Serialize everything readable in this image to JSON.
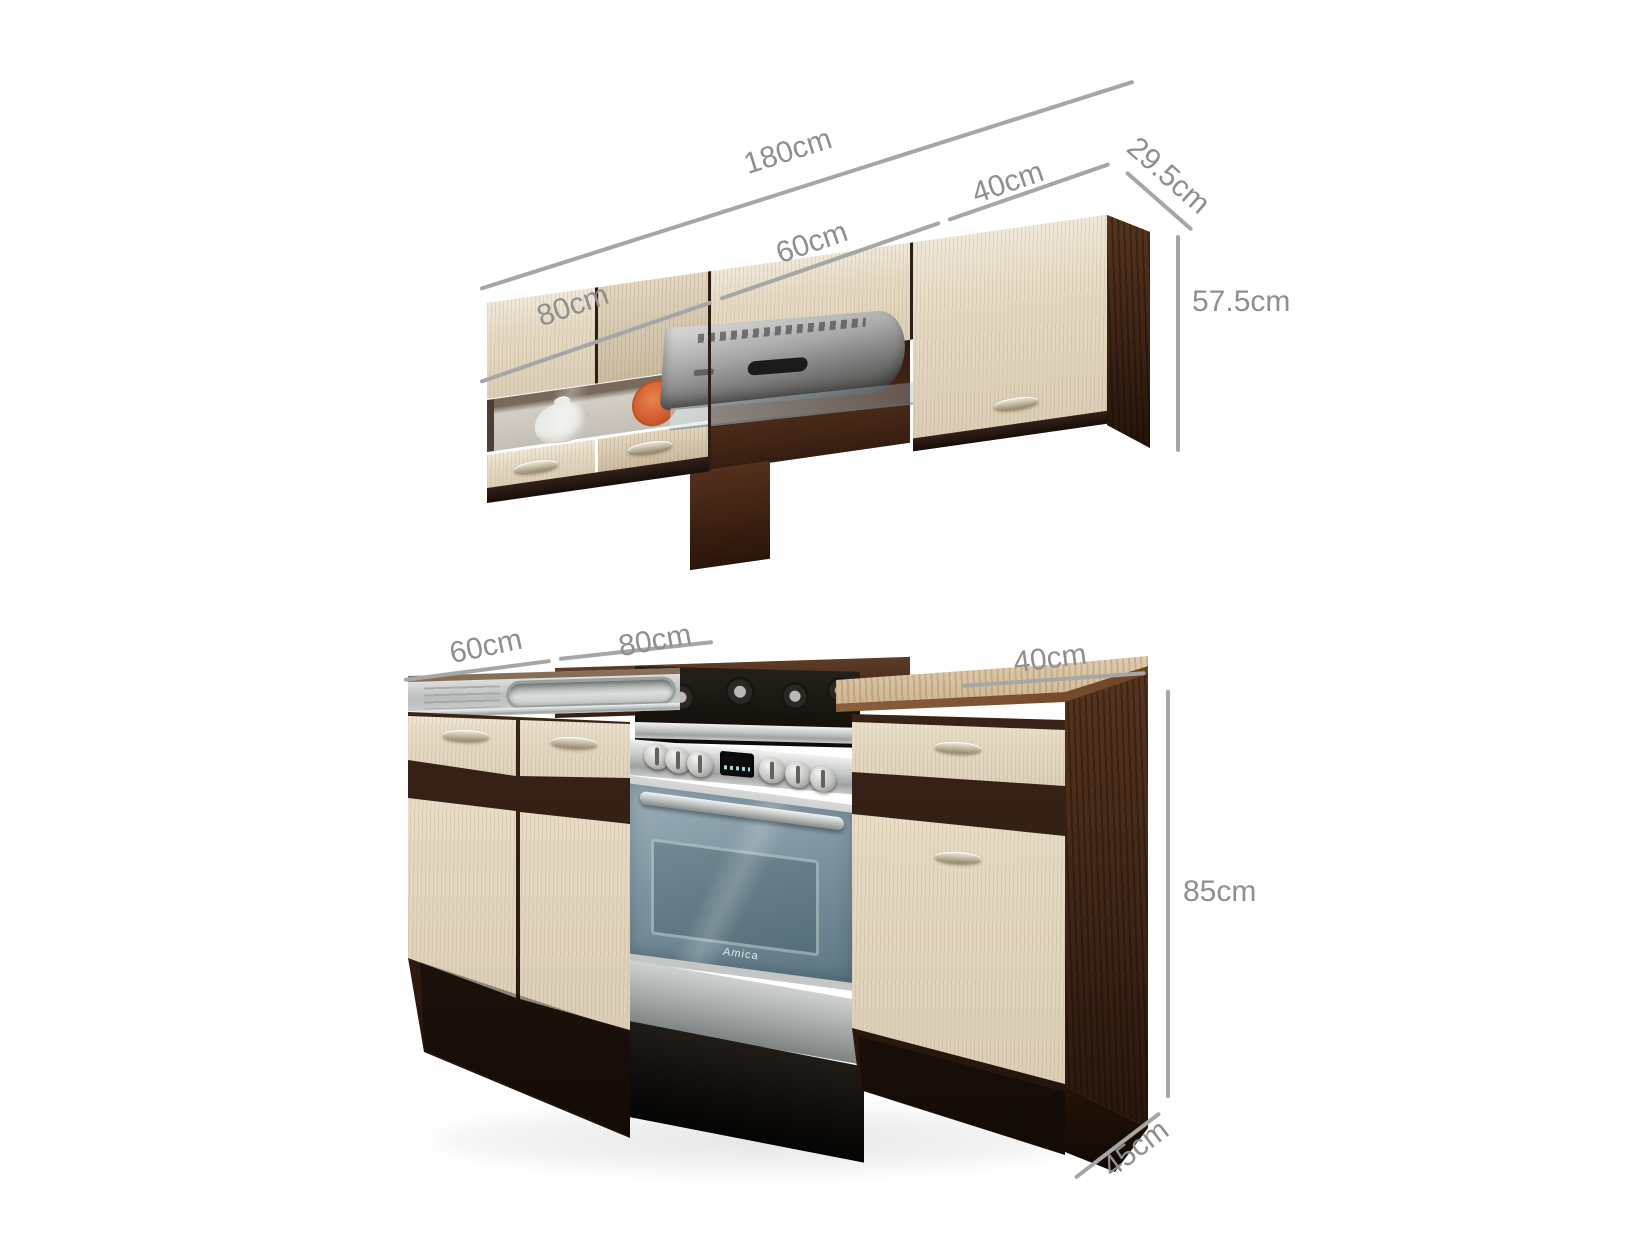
{
  "scene": {
    "type": "product-dimension-photo",
    "background": "#ffffff",
    "subject": "kitchen cabinet set (light ash fronts, dark walnut carcass) with range hood, sink and freestanding oven"
  },
  "wall_unit": {
    "dims": {
      "total": "180cm",
      "left_cabinet": "80cm",
      "middle_cabinet": "60cm",
      "right_cabinet": "40cm",
      "depth": "29.5cm",
      "height": "57.5cm"
    }
  },
  "base_unit": {
    "dims": {
      "left_cabinet": "60cm",
      "middle_cabinet": "80cm",
      "right_cabinet": "40cm",
      "height": "85cm",
      "depth": "45cm"
    },
    "oven_brand": "Amica"
  },
  "colors": {
    "wood_light": "#e7dbc5",
    "wood_walnut_dark": "#3f2519",
    "counter_steel": "#c6c9c7",
    "counter_wood": "#c89b66",
    "oven_glass": "#7e95a1",
    "accent_orange_plate": "#dd5418",
    "dim_line": "#a6a6a6",
    "dim_text": "#8f8f8f"
  }
}
